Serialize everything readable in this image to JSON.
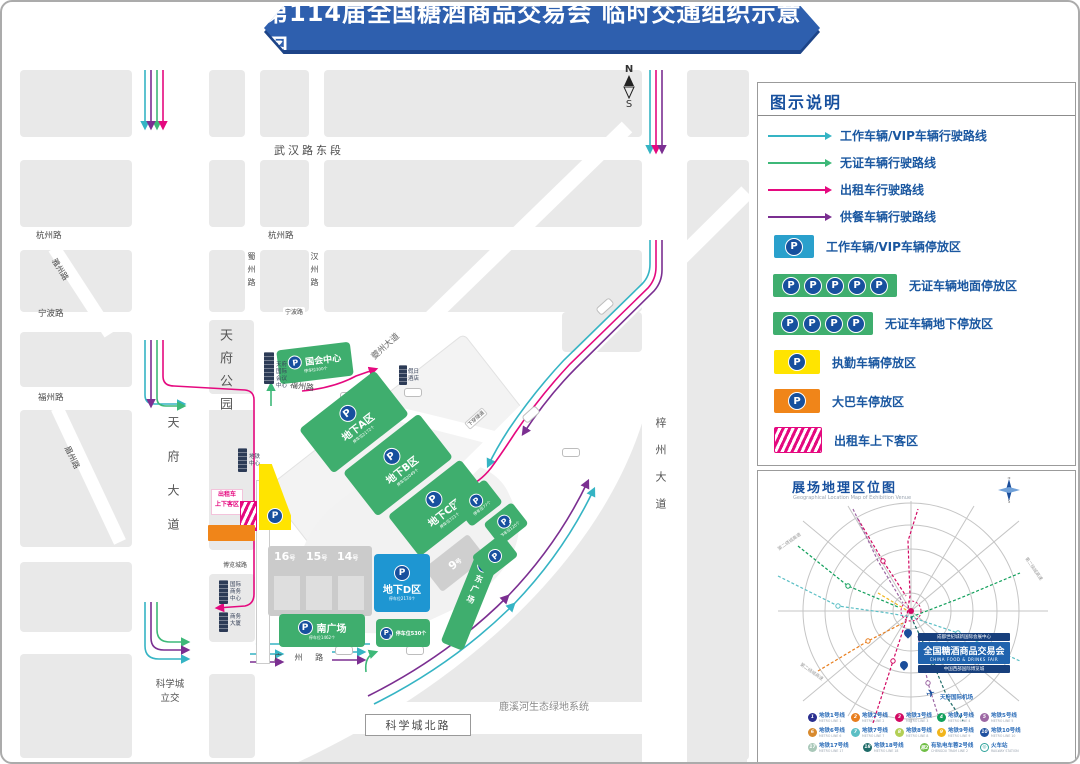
{
  "title": "第114届全国糖酒商品交易会  临时交通组织示意图",
  "compass": {
    "n": "N",
    "s": "S"
  },
  "legend": {
    "header": "图示说明",
    "routes": [
      {
        "label": "工作车辆/VIP车辆行驶路线",
        "color": "#35B4C4"
      },
      {
        "label": "无证车辆行驶路线",
        "color": "#3DB878"
      },
      {
        "label": "出租车行驶路线",
        "color": "#E5097F"
      },
      {
        "label": "供餐车辆行驶路线",
        "color": "#7B2F91"
      }
    ],
    "zones": [
      {
        "label": "工作车辆/VIP车辆停放区",
        "color": "#2AA0CC"
      },
      {
        "label": "无证车辆地面停放区",
        "color": "#3FAE6E"
      },
      {
        "label": "无证车辆地下停放区",
        "color": "#3FAE6E"
      },
      {
        "label": "执勤车辆停放区",
        "color": "#FFE400"
      },
      {
        "label": "大巴车停放区",
        "color": "#F08519"
      },
      {
        "label": "出租车上下客区",
        "color": "#E5097F"
      }
    ]
  },
  "map": {
    "roads": {
      "wuhan": "武汉路东段",
      "hangzhou_left": "杭州路",
      "hangzhou_mid": "杭州路",
      "yazhou": "雅州路",
      "ningbo_left": "宁波路",
      "ningbo_mid": "宁波路",
      "fuzhou_left": "福州路",
      "fuzhou_mid": "福州路",
      "meizhou": "眉州路",
      "tianfu": "天府大道",
      "shuzhou": "蜀州路",
      "hanzhou": "汉州路",
      "kuizhou": "夔州大道",
      "zizhou": "梓州大道",
      "bolancheng": "博览城路",
      "guangzhou": "广 州 路",
      "kexuecheng_north": "科学城北路",
      "kexuecheng_interchange": "科学城\n立交",
      "underpass": "下穿隧道",
      "luxi": "鹿溪河生态绿地系统"
    },
    "park": "天府公园",
    "zones": {
      "guohui": {
        "name": "国会中心",
        "sub": "停车位300个"
      },
      "a": {
        "name": "地下A区",
        "sub": "停车位2172个"
      },
      "b": {
        "name": "地下B区",
        "sub": "停车位2049个"
      },
      "c": {
        "name": "地下C区",
        "sub": "停车位721个"
      },
      "d": {
        "name": "地下D区",
        "sub": "停车位2174个"
      },
      "south": {
        "name": "南广场",
        "sub": "停车位1462个"
      },
      "east": {
        "name": "东广场"
      },
      "p3": {
        "digit": "3",
        "text": "停车位530个"
      },
      "r1": {
        "sub": "停车位77个"
      },
      "r2": {
        "digit": "4",
        "sub": "停车位120个"
      }
    },
    "halls": {
      "h16": "16",
      "h15": "15",
      "h14": "14",
      "h9": "9",
      "suffix": "号"
    },
    "buildings": {
      "conference": "天府国际会议中心",
      "metro": "地铁中心",
      "hotel": "假日酒店",
      "biz": "国际商务中心",
      "tower": "商务大厦"
    },
    "taxi_area": "出租车\n上下客区"
  },
  "inset": {
    "title": "展场地理区位图",
    "subtitle": "Geographical Location Map of Exhibition Venue",
    "ring_road": "第二绕城高速",
    "badge": {
      "top": "成都世纪城新国际会展中心",
      "main": "全国糖酒商品交易会",
      "en": "CHINA FOOD & DRINKS FAIR",
      "bottom": "中国西部国际博览城"
    },
    "airport": "天府国际机场",
    "metro": [
      {
        "num": "1",
        "label": "地铁1号线",
        "sub": "METRO LINE 1",
        "color": "#2A2F8F"
      },
      {
        "num": "2",
        "label": "地铁2号线",
        "sub": "METRO LINE 2",
        "color": "#E87E1E"
      },
      {
        "num": "3",
        "label": "地铁3号线",
        "sub": "METRO LINE 3",
        "color": "#D20A63"
      },
      {
        "num": "4",
        "label": "地铁4号线",
        "sub": "METRO LINE 4",
        "color": "#12A05C"
      },
      {
        "num": "5",
        "label": "地铁5号线",
        "sub": "METRO LINE 5",
        "color": "#9D68A4"
      },
      {
        "num": "6",
        "label": "地铁6号线",
        "sub": "METRO LINE 6",
        "color": "#D88A2E"
      },
      {
        "num": "7",
        "label": "地铁7号线",
        "sub": "METRO LINE 7",
        "color": "#5BBFC5"
      },
      {
        "num": "8",
        "label": "地铁8号线",
        "sub": "METRO LINE 8",
        "color": "#B3CF55"
      },
      {
        "num": "9",
        "label": "地铁9号线",
        "sub": "METRO LINE 9",
        "color": "#F1B51C"
      },
      {
        "num": "10",
        "label": "地铁10号线",
        "sub": "METRO LINE 10",
        "color": "#20519F"
      },
      {
        "num": "17",
        "label": "地铁17号线",
        "sub": "METRO LINE 17",
        "color": "#A9C8B9"
      },
      {
        "num": "18",
        "label": "地铁18号线",
        "sub": "METRO LINE 18",
        "color": "#1E6B68"
      },
      {
        "num": "蓉2",
        "label": "有轨电车蓉2号线",
        "sub": "CHENGDU TRAM LINE 2",
        "color": "#6FBE45"
      },
      {
        "num": "◎",
        "label": "火车站",
        "sub": "RAILWAY STATION",
        "color": "#FFFFFF"
      }
    ]
  }
}
